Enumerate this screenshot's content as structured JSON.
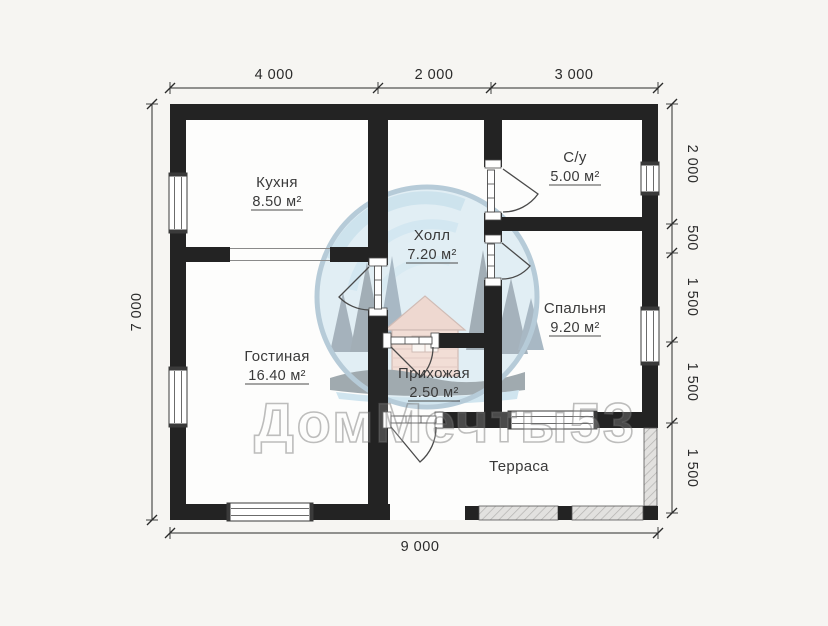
{
  "plan": {
    "rooms": [
      {
        "name": "Кухня",
        "area": "8.50 м²"
      },
      {
        "name": "С/у",
        "area": "5.00 м²"
      },
      {
        "name": "Холл",
        "area": "7.20 м²"
      },
      {
        "name": "Спальня",
        "area": "9.20 м²"
      },
      {
        "name": "Гостиная",
        "area": "16.40 м²"
      },
      {
        "name": "Прихожая",
        "area": "2.50 м²"
      },
      {
        "name": "Терраса",
        "area": ""
      }
    ],
    "dimensions": {
      "top": [
        "4 000",
        "2 000",
        "3 000"
      ],
      "right": [
        "2 000",
        "500",
        "1 500",
        "1 500",
        "1 500"
      ],
      "left": [
        "7 000"
      ],
      "bottom": [
        "9 000"
      ]
    },
    "watermark": "ДомМечты53",
    "colors": {
      "wall": "#232323",
      "background": "#f6f5f2",
      "logo_sky": "#b9d9ea",
      "logo_trees": "#24455e",
      "logo_house": "#e3b09e"
    }
  }
}
